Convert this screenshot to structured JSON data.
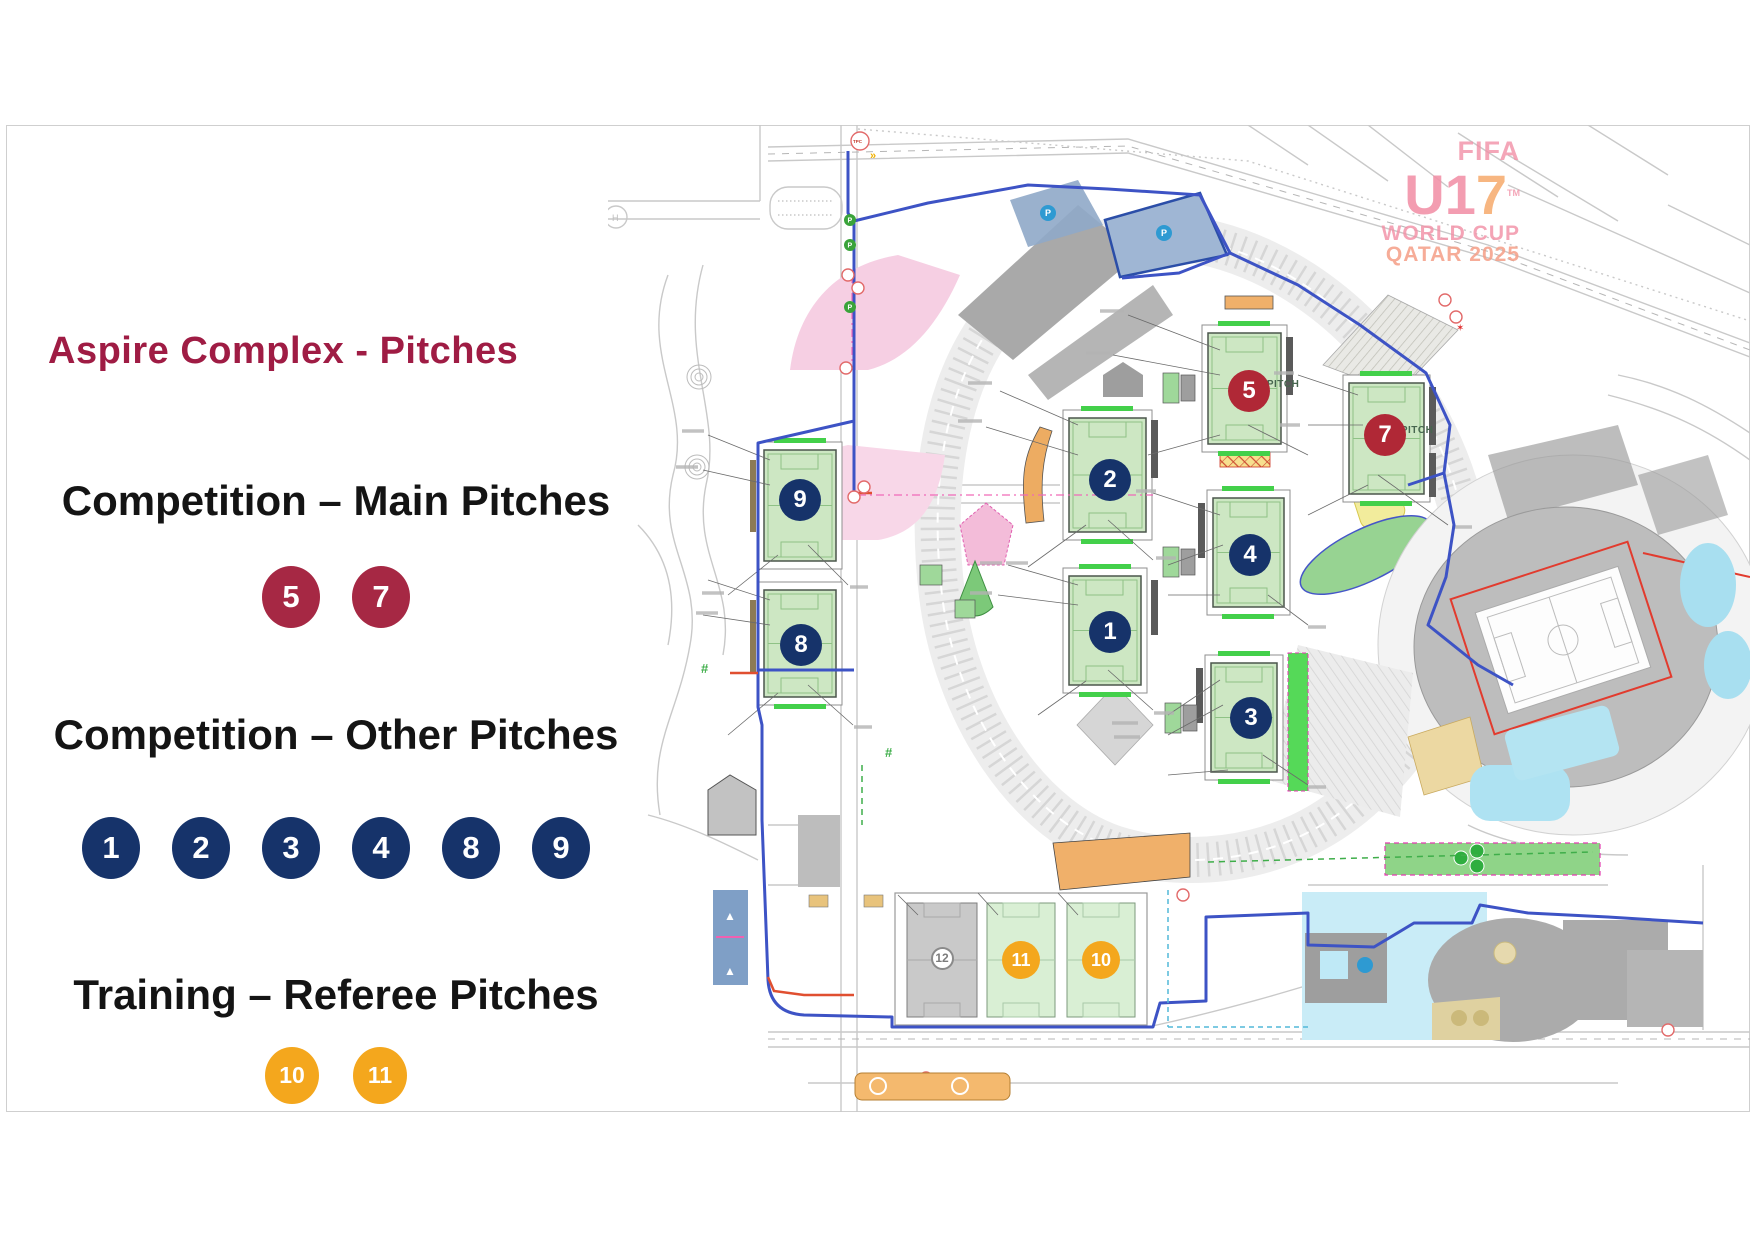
{
  "legend": {
    "title": "Aspire Complex - Pitches",
    "title_color": "#9F1C44",
    "sections": [
      {
        "label": "Competition – Main Pitches",
        "badge_color": "#A62844",
        "badges": [
          "5",
          "7"
        ]
      },
      {
        "label": "Competition – Other Pitches",
        "badge_color": "#16336A",
        "badges": [
          "1",
          "2",
          "3",
          "4",
          "8",
          "9"
        ]
      },
      {
        "label": "Training – Referee Pitches",
        "badge_color": "#F4A71D",
        "badges": [
          "10",
          "11"
        ]
      }
    ]
  },
  "map": {
    "badge_colors": {
      "main": "#B02836",
      "other": "#16336A",
      "training": "#F4A71D",
      "neutral": "#FFFFFF"
    },
    "badges": [
      {
        "n": "5",
        "type": "main",
        "x": 641,
        "y": 266
      },
      {
        "n": "7",
        "type": "main",
        "x": 777,
        "y": 310
      },
      {
        "n": "2",
        "type": "other",
        "x": 502,
        "y": 355
      },
      {
        "n": "4",
        "type": "other",
        "x": 642,
        "y": 430
      },
      {
        "n": "1",
        "type": "other",
        "x": 502,
        "y": 507
      },
      {
        "n": "3",
        "type": "other",
        "x": 643,
        "y": 593
      },
      {
        "n": "9",
        "type": "other",
        "x": 192,
        "y": 375
      },
      {
        "n": "8",
        "type": "other",
        "x": 193,
        "y": 520
      },
      {
        "n": "11",
        "type": "training",
        "x": 413,
        "y": 835
      },
      {
        "n": "10",
        "type": "training",
        "x": 493,
        "y": 835
      },
      {
        "n": "12",
        "type": "neutral",
        "x": 334,
        "y": 833
      }
    ],
    "labels": {
      "main_pitch": "MAIN PITCH",
      "tpc": "TPC"
    },
    "logo": {
      "line1": "FIFA",
      "line2": "U1",
      "seven": "7",
      "tm": "TM",
      "line3": "WORLD CUP",
      "line4": "QATAR 2025"
    }
  }
}
